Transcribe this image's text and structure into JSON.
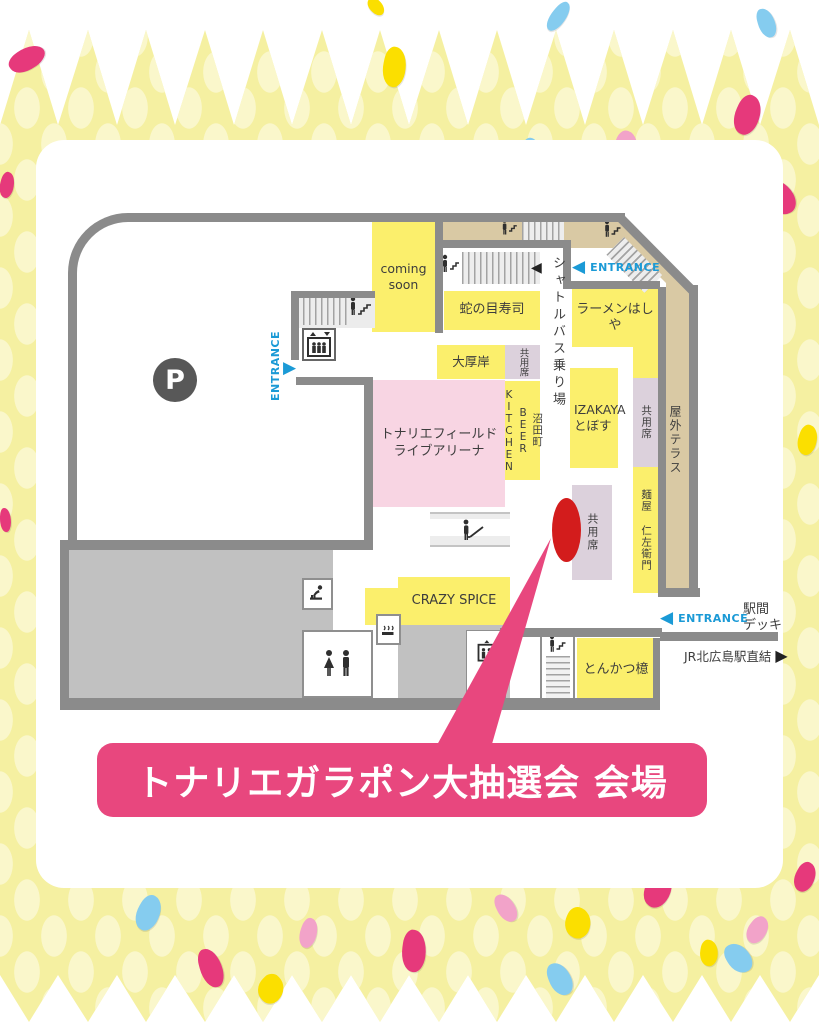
{
  "event": {
    "banner": "トナリエガラポン大抽選会 会場"
  },
  "map": {
    "parking": "P",
    "coming_soon": "coming soon",
    "janome_sushi": "蛇の目寿司",
    "shuttle_bus_stop": "シャトルバス乗り場",
    "ramen_hashiya": "ラーメンはしや",
    "daiakkeshi": "大厚岸",
    "shared_seat_top": "共用席",
    "numata_col1": "沼田町",
    "numata_col2": "BEER",
    "numata_col3": "KITCHEN",
    "arena_line1": "トナリエフィールド",
    "arena_line2": "ライブアリーナ",
    "izakaya_line1": "IZAKAYA",
    "izakaya_line2": "とぼす",
    "shared_seat_mid": "共用席",
    "outdoor_terrace": "屋外テラス",
    "menya_nizaemon": "麺屋 仁左衛門",
    "shared_seat_event": "共用席",
    "crazy_spice": "CRAZY SPICE",
    "tonkatsu_aoki": "とんかつ檍",
    "entrance_left": "ENTRANCE",
    "entrance_top_right": "ENTRANCE",
    "entrance_bottom_right": "ENTRANCE",
    "station_deck_line1": "駅間",
    "station_deck_line2": "デッキ",
    "jr_link": "JR北広島駅直結"
  },
  "icons": {
    "arrow_left": "◀",
    "arrow_right": "▶"
  },
  "colors": {
    "accent_pink": "#E8477E",
    "marker_red": "#D31C1C",
    "entrance_blue": "#1B9AD6",
    "room_yellow": "#FBEF6C",
    "shared_purple": "#DCD1DC",
    "terrace_tan": "#D9C9A4",
    "arena_pink": "#F8D5E3",
    "wall_gray": "#8B8B8B",
    "border_yellow": "#F5F0A1"
  }
}
